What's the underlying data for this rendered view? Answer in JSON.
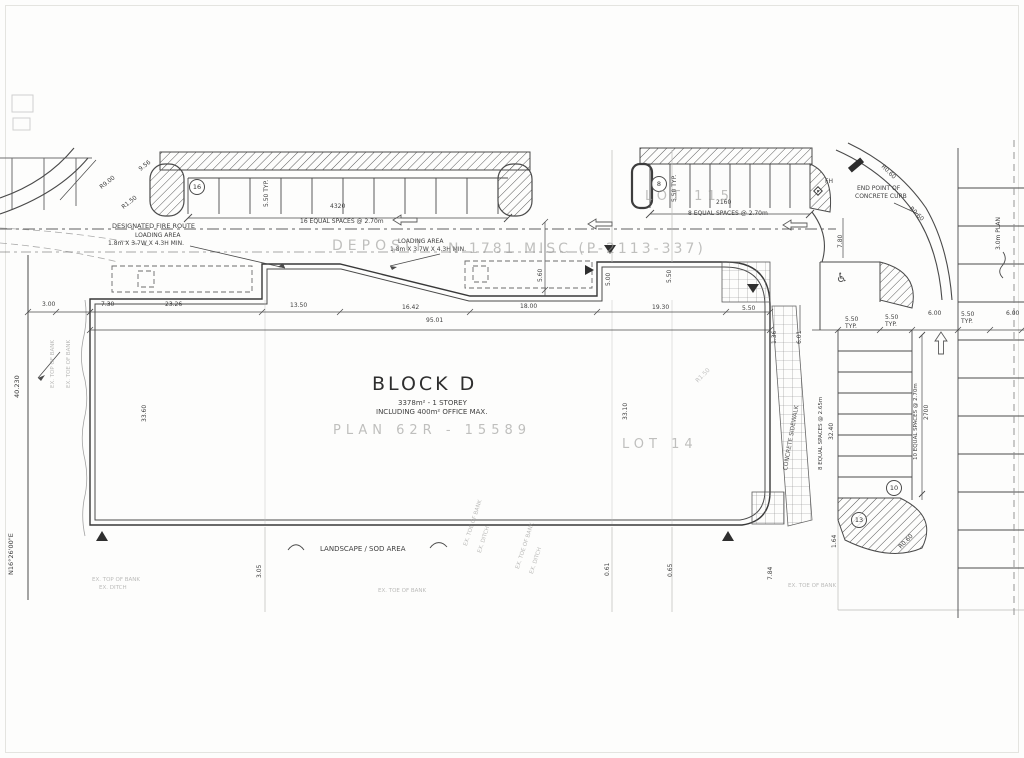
{
  "plan": {
    "building": {
      "title": "BLOCK D",
      "area_storey": "3378m² - 1 STOREY",
      "office": "INCLUDING 400m² OFFICE MAX.",
      "stamp": "PLAN  62R - 15589"
    },
    "watermarks": {
      "deposit": "DEPOSIT",
      "plan_ref": "N 1781 MISC (P-2113-337)",
      "lot_115": "LOT 115",
      "lot_14": "LOT 14"
    },
    "notes": {
      "fire_route": "DESIGNATED FIRE ROUTE",
      "loading_area": "LOADING AREA",
      "loading_min": "1.8m X 3.7W X 4.3H MIN.",
      "end_point_line1": "END POINT OF",
      "end_point_line2": "CONCRETE CURB",
      "landscape": "LANDSCAPE / SOD AREA",
      "sidewalk": "CONCRETE SIDEWALK",
      "fh": "FH",
      "ex_top": "EX. TOP OF BANK",
      "ex_toe": "EX. TOE OF BANK",
      "ex_ditch": "EX. DITCH"
    },
    "stalls": {
      "row_left_count": "16",
      "row_right_count": "8",
      "col_count": "10",
      "col_count2": "13"
    },
    "dims": {
      "d4320": "4320",
      "spaces16": "16 EQUAL SPACES @ 2.70m",
      "d2160": "2160",
      "spaces8": "8 EQUAL SPACES @ 2.70m",
      "d2700": "2700",
      "spaces10": "10 EQUAL SPACES @ 2.70m",
      "spaces8b": "8 EQUAL SPACES @ 2.65m",
      "typv": "5.50 TYP.",
      "d550": "5.50",
      "typ": "TYP.",
      "d600": "6.00",
      "d601": "6.01",
      "d136": "1.36",
      "d9501": "95.01",
      "d2326": "23.26",
      "d1350": "13.50",
      "d1642": "16.42",
      "d1800": "18.00",
      "d1930": "19.30",
      "d300": "3.00",
      "d730": "7.30",
      "d40230": "40.230",
      "bearing": "N16°26'00\"E",
      "d3360": "33.60",
      "d3310": "33.10",
      "d3240": "32.40",
      "d560": "5.60",
      "d500": "5.00",
      "d780": "7.80",
      "d784": "7.84",
      "d061": "0.61",
      "d065": "0.65",
      "d305": "3.05",
      "d164": "1.64",
      "r060": "R0.60",
      "r900": "R9.00",
      "r150": "R1.50",
      "d956": "9.56",
      "d3m": "3.0m PLAN"
    },
    "icons": {
      "wheelchair": "♿"
    }
  }
}
